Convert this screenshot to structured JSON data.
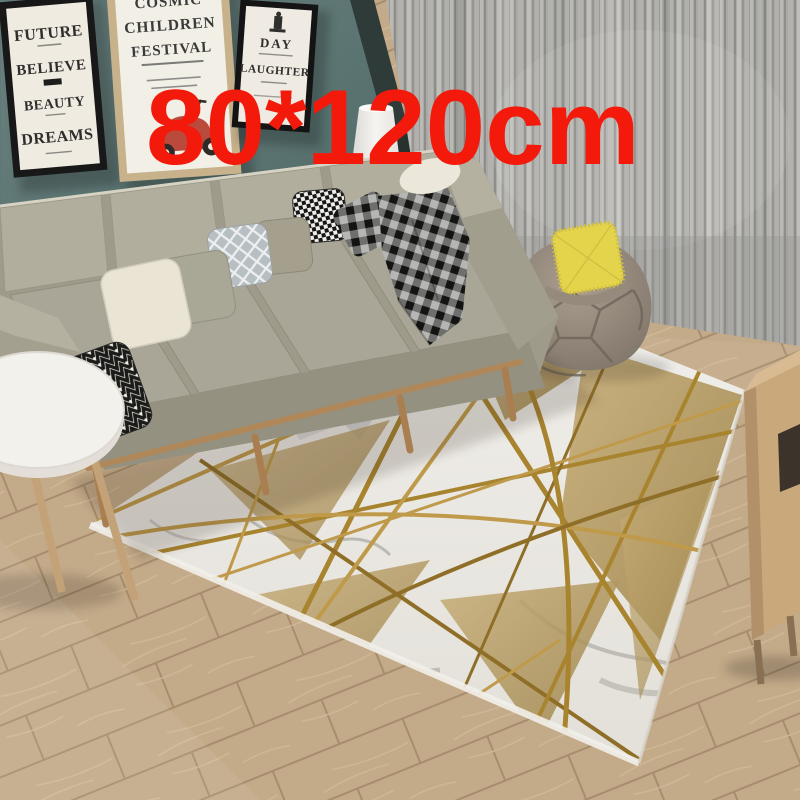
{
  "overlay": {
    "size_label": "80*120cm",
    "label_color": "#f31a0c"
  },
  "posters": {
    "future": {
      "line1": "FUTURE",
      "line2": "BELIEVE",
      "line3": "BEAUTY",
      "line4": "DREAMS"
    },
    "festival": {
      "line1": "COSMIC",
      "line2": "CHILDREN",
      "line3": "FESTIVAL"
    },
    "laughter": {
      "line1": "DAY",
      "line2": "LAUGHTER"
    }
  },
  "colors": {
    "accent_red": "#f31a0c",
    "wall_teal": "#5d7572",
    "window_frame_dark": "#2e3b39",
    "curtain_gray": "#a9a9a5",
    "sofa_body": "#9e9b8b",
    "sofa_cushion": "#a9a697",
    "pillow_cream": "#eae4d4",
    "pillow_sage": "#a9a896",
    "pillow_taupe": "#a59f8e",
    "pillow_yellow": "#e4d44c",
    "beanbag_taupe": "#988b7e",
    "rug_white": "#edebe6",
    "rug_gold": "#b3985e",
    "rug_gold_line": "#a8842f",
    "floor_wood": "#c3aa89",
    "wood_furniture": "#c9a87c",
    "side_table_white": "#f3f1ec"
  }
}
